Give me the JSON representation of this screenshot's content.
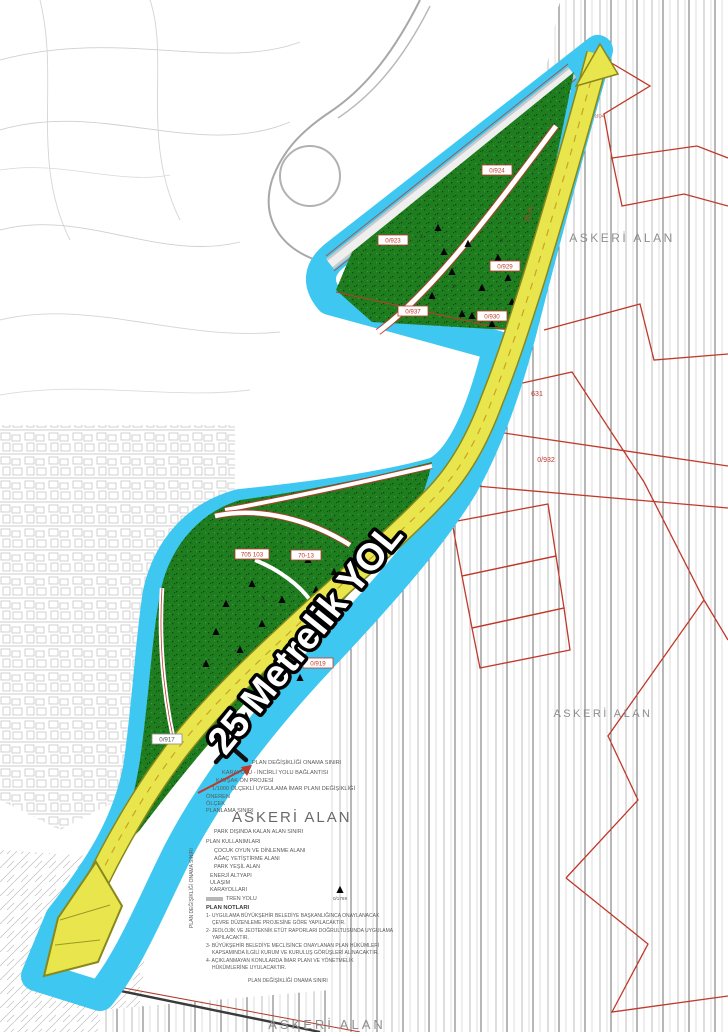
{
  "labels": {
    "road": "25 Metrelik YOL",
    "military_area": "ASKERİ ALAN",
    "road_note": "25 m"
  },
  "parcels": {
    "p924": "0/924",
    "p923": "0/923",
    "p929": "0/929",
    "p937": "0/937",
    "p930": "0/930",
    "p931": "631",
    "p932": "0/932",
    "p804": "804",
    "p919": "0/919",
    "p917": "0/917",
    "p705": "705 103",
    "p7013": "70-13"
  },
  "legend": {
    "header_lines": [
      "PLAN DEĞİŞİKLİĞİ ONAMA SINIRI",
      "KARAYOLU - İNCİRLİ YOLU BAĞLANTISI",
      "KAVŞAK ÖN PROJESİ",
      "1/1000 ÖLÇEKLİ UYGULAMA İMAR PLANI DEĞİŞİKLİĞİ",
      "ÖNEREN",
      "ÖLÇEK",
      "PLANLAMA SINIRI"
    ],
    "big_label": "ASKERİ ALAN",
    "items": [
      "PARK DIŞINDA KALAN ALAN SINIRI",
      "PLAN KULLANIMLARI",
      "ÇOCUK OYUN VE DİNLENME ALANI",
      "AĞAÇ YETİŞTİRME ALANI",
      "PARK YEŞİL ALAN",
      "ENERJİ ALTYAPI",
      "ULAŞIM",
      "KARAYOLLARI",
      "TREN YOLU"
    ],
    "notes_title": "PLAN NOTLARI",
    "notes": [
      "1- UYGULAMA BÜYÜKŞEHİR BELEDİYE BAŞKANLIĞINCA ONAYLANACAK",
      "ÇEVRE DÜZENLEME PROJESİNE GÖRE YAPILACAKTIR.",
      "2- JEOLOJİK VE JEOTEKNİK ETÜT RAPORLARI DOĞRULTUSUNDA UYGULAMA",
      "YAPILACAKTIR.",
      "3- BÜYÜKŞEHİR BELEDİYE MECLİSİNCE ONAYLANAN PLAN HÜKÜMLERİ",
      "KAPSAMINDA İLGİLİ KURUM VE KURULUŞ GÖRÜŞLERİ ALINACAKTIR.",
      "4- AÇIKLANMAYAN KONULARDA İMAR PLANI VE YÖNETMELİK",
      "HÜKÜMLERİNE UYULACAKTIR."
    ],
    "footer": "PLAN DEĞİŞİKLİĞİ ONAMA SINIRI",
    "side_label": "PLAN DEĞİŞİKLİĞİ ONAMA SINIRI",
    "point_label": "0/1769"
  },
  "colors": {
    "corridor": "#3EC7F0",
    "road_fill": "#E9E64D",
    "road_edge": "#88881C",
    "forest": "#1F7D20",
    "parcel_red": "#C0392B",
    "label_gray": "#8F8F8F"
  }
}
